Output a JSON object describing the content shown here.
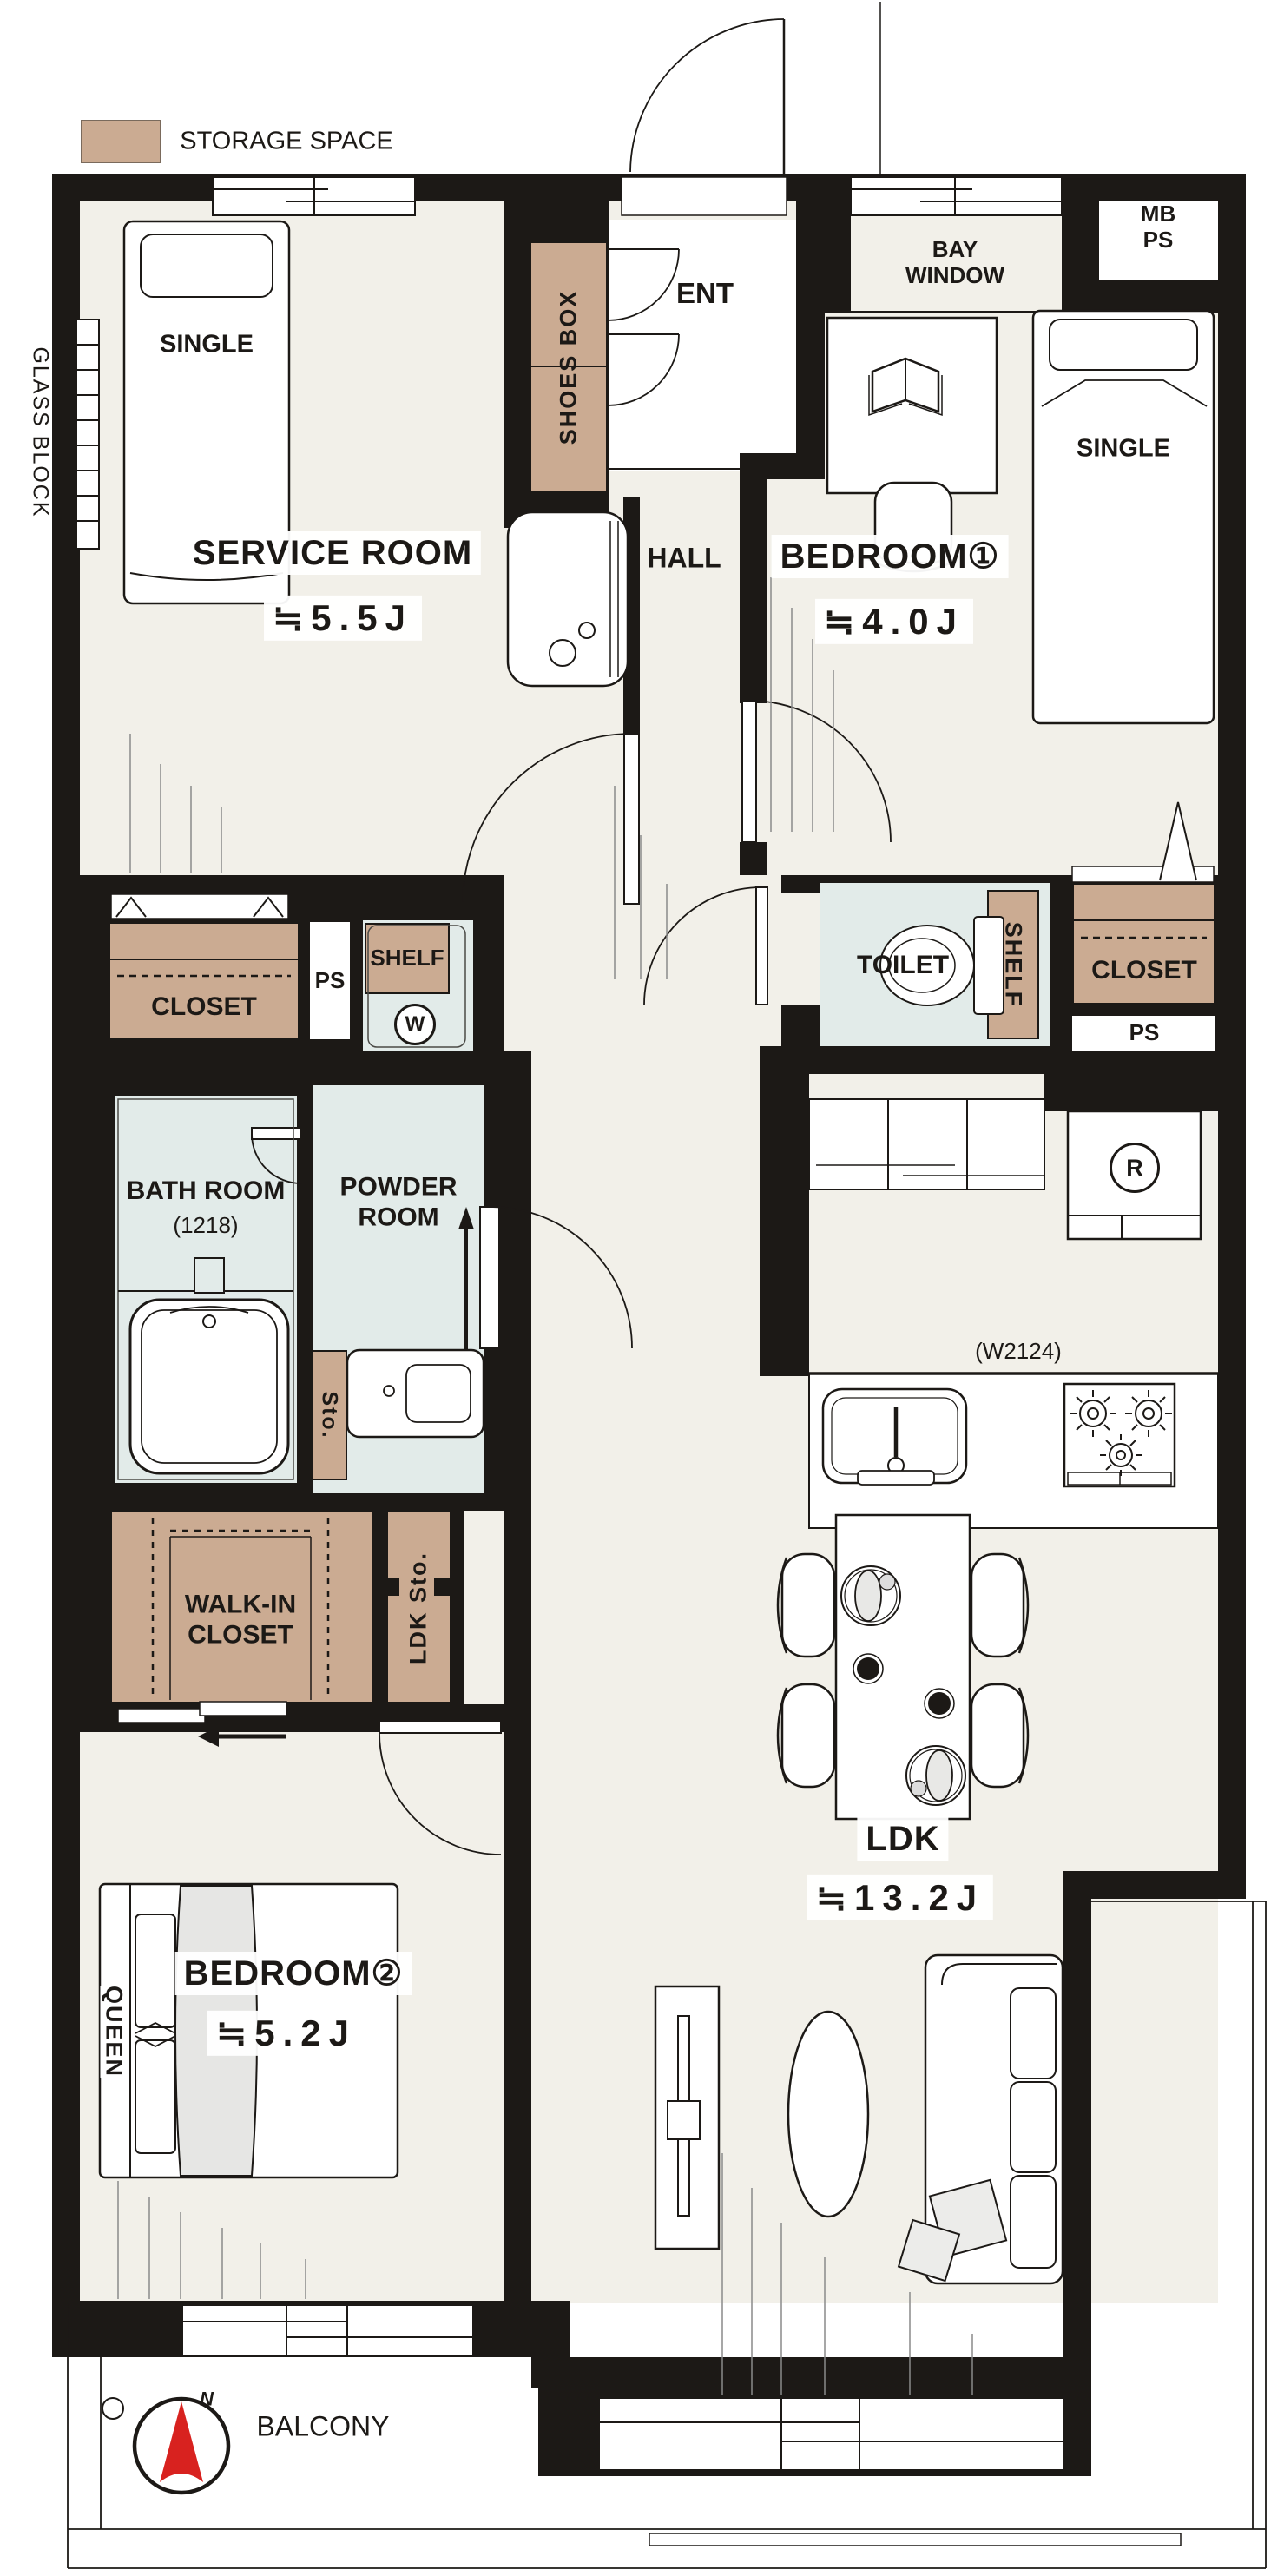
{
  "legend": {
    "label": "STORAGE SPACE"
  },
  "annotations": {
    "glass_block": "GLASS BLOCK",
    "kitchen_width": "(W2124)",
    "compass_north": "N"
  },
  "rooms": {
    "service_room": {
      "name": "SERVICE ROOM",
      "size": "≒5.5J"
    },
    "bedroom1": {
      "name": "BEDROOM①",
      "size": "≒4.0J"
    },
    "bedroom2": {
      "name": "BEDROOM②",
      "size": "≒5.2J"
    },
    "ldk": {
      "name": "LDK",
      "size": "≒13.2J"
    },
    "bathroom": {
      "name": "BATH ROOM",
      "size": "(1218)"
    },
    "powder_room": {
      "name": "POWDER ROOM"
    },
    "toilet": {
      "name": "TOILET"
    },
    "hall": {
      "name": "HALL"
    },
    "ent": {
      "name": "ENT"
    },
    "bay_window": {
      "name": "BAY WINDOW"
    },
    "balcony": {
      "name": "BALCONY"
    }
  },
  "storage": {
    "shoes_box": "SHOES BOX",
    "closet_left": "CLOSET",
    "closet_right": "CLOSET",
    "shelf_top": "SHELF",
    "shelf_toilet": "SHELF",
    "walk_in_closet": "WALK-IN CLOSET",
    "ldk_sto": "LDK Sto.",
    "sto": "Sto."
  },
  "fixtures": {
    "washer": "W",
    "fridge": "R",
    "ps_left": "PS",
    "ps_right": "PS",
    "mb_ps": "MB PS"
  },
  "beds": {
    "single_service": "SINGLE",
    "single_bedroom1": "SINGLE",
    "queen": "QUEEN"
  }
}
